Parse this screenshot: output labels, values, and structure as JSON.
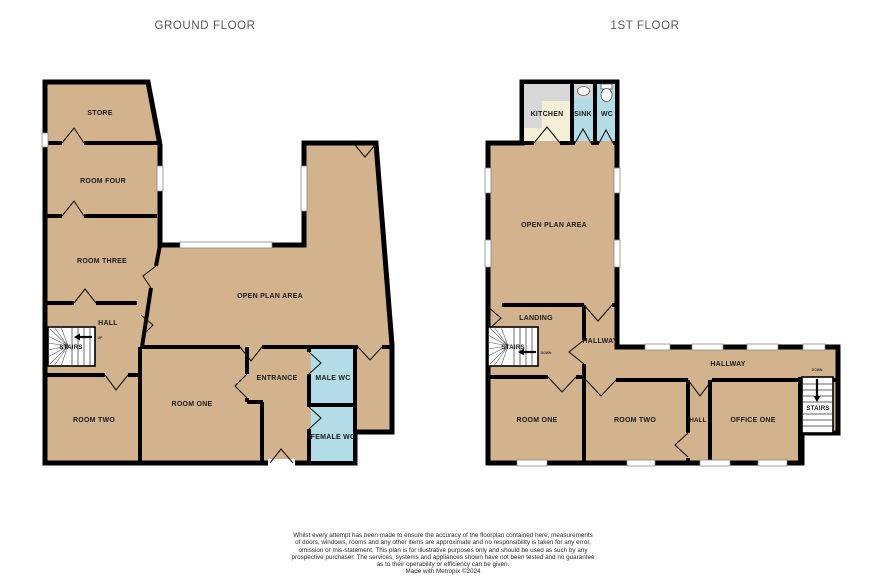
{
  "titles": {
    "ground": "GROUND FLOOR",
    "first": "1ST FLOOR"
  },
  "colors": {
    "room_fill": "#d2b38e",
    "wet_room_fill": "#b4dce6",
    "kitchen_fill": "#f6efd8",
    "counter_fill": "#d8d8d8",
    "wall": "#000000"
  },
  "ground_floor": {
    "rooms": {
      "store": "STORE",
      "room_four": "ROOM FOUR",
      "room_three": "ROOM THREE",
      "hall": "HALL",
      "stairs": "STAIRS",
      "stairs_direction": "UP",
      "room_two": "ROOM TWO",
      "room_one": "ROOM ONE",
      "entrance": "ENTRANCE",
      "male_wc": "MALE WC",
      "female_wc": "FEMALE WC",
      "open_plan": "OPEN PLAN AREA"
    }
  },
  "first_floor": {
    "rooms": {
      "kitchen": "KITCHEN",
      "sink": "SINK",
      "wc": "WC",
      "open_plan": "OPEN PLAN AREA",
      "landing": "LANDING",
      "stairs_left": "STAIRS",
      "stairs_left_direction": "DOWN",
      "hallway_upper": "HALLWAY",
      "hallway_lower": "HALLWAY",
      "room_one": "ROOM ONE",
      "room_two": "ROOM TWO",
      "hall": "HALL",
      "office_one": "OFFICE ONE",
      "stairs_right": "STAIRS",
      "stairs_right_direction": "DOWN"
    }
  },
  "footer": {
    "lines": [
      "Whilst every attempt has been made to ensure the accuracy of the floorplan contained here, measurements",
      "of doors, windows, rooms and any other items are approximate and no responsibility is taken for any error,",
      "omission or mis-statement. This plan is for illustrative purposes only and should be used as such by any",
      "prospective purchaser. The services, systems and appliances shown have not been tested and no guarantee",
      "as to their operability or efficiency can be given.",
      "Made with Metropix ©2024"
    ]
  }
}
